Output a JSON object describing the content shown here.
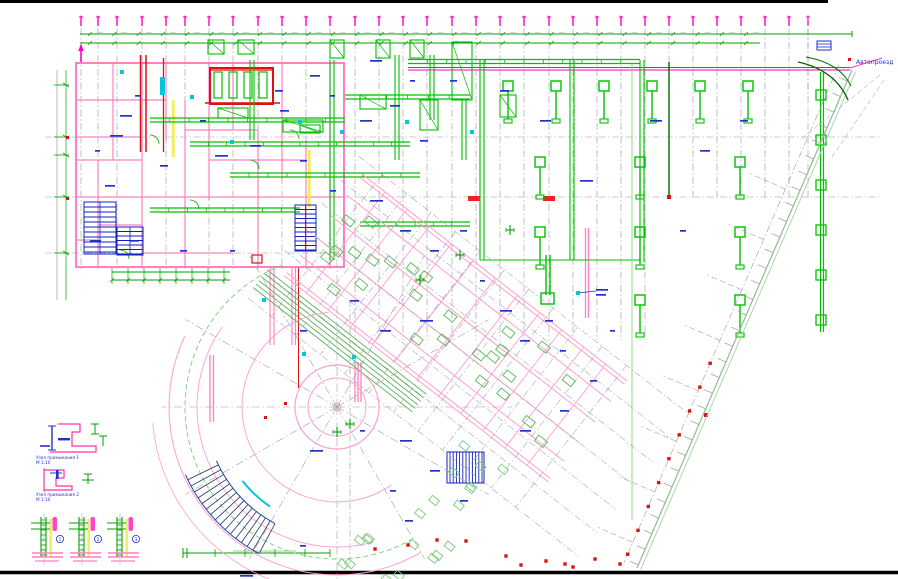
{
  "drawing": {
    "road_label": "Автопроезд",
    "details": {
      "node1_caption": "Узел примыкания 1",
      "node1_scale": "М 1:10",
      "node2_caption": "Узел примыкания 2",
      "node2_scale": "М 1:10",
      "wall_sections": [
        {
          "number": "1"
        },
        {
          "number": "2"
        },
        {
          "number": "3"
        }
      ]
    },
    "palette": {
      "wall_pink": "#ff7fc0",
      "magenta": "#ff00bb",
      "bright_green": "#00c000",
      "dark_green": "#006a00",
      "pale_green": "#8fbc8f",
      "annotation_blue": "#2230cc",
      "cyan": "#00c8d8",
      "red": "#dd1111",
      "yellow": "#f2ee55",
      "grid_gray": "#9a9aa2",
      "frame_black": "#000000",
      "paper_white": "#ffffff"
    }
  }
}
